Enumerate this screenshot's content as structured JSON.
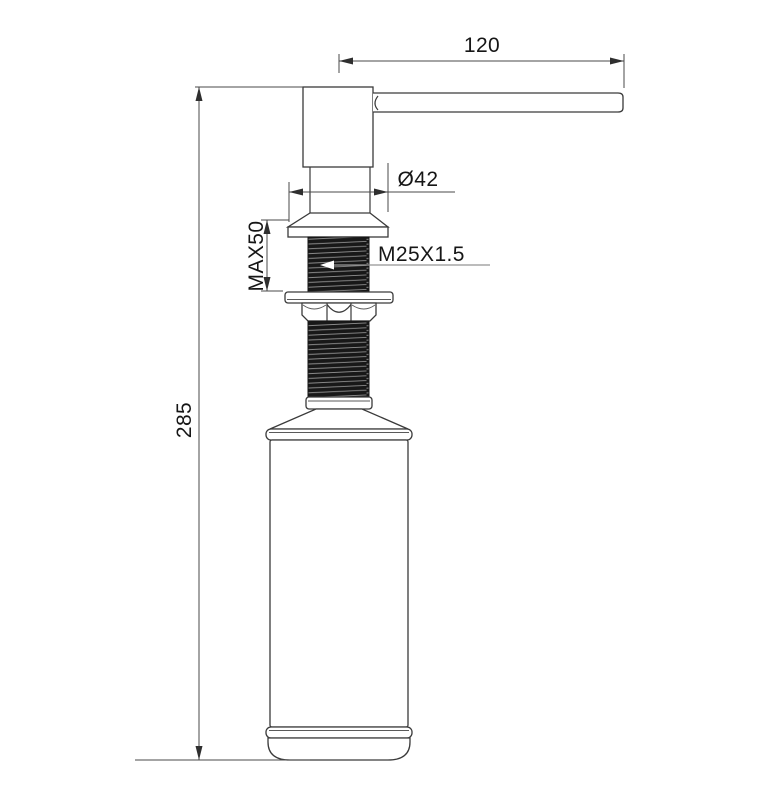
{
  "labels": {
    "spout_length": "120",
    "overall_height": "285",
    "flange_diameter": "Ø42",
    "max_mounting_thickness": "MAX50",
    "thread_spec": "M25X1.5"
  },
  "colors": {
    "outline": "#3a3a3a",
    "dimension_line": "#4a4a4a",
    "leader_line": "#949494",
    "text": "#161616",
    "thread_dark": "#181818",
    "thread_highlight": "#909090",
    "background": "#ffffff"
  }
}
